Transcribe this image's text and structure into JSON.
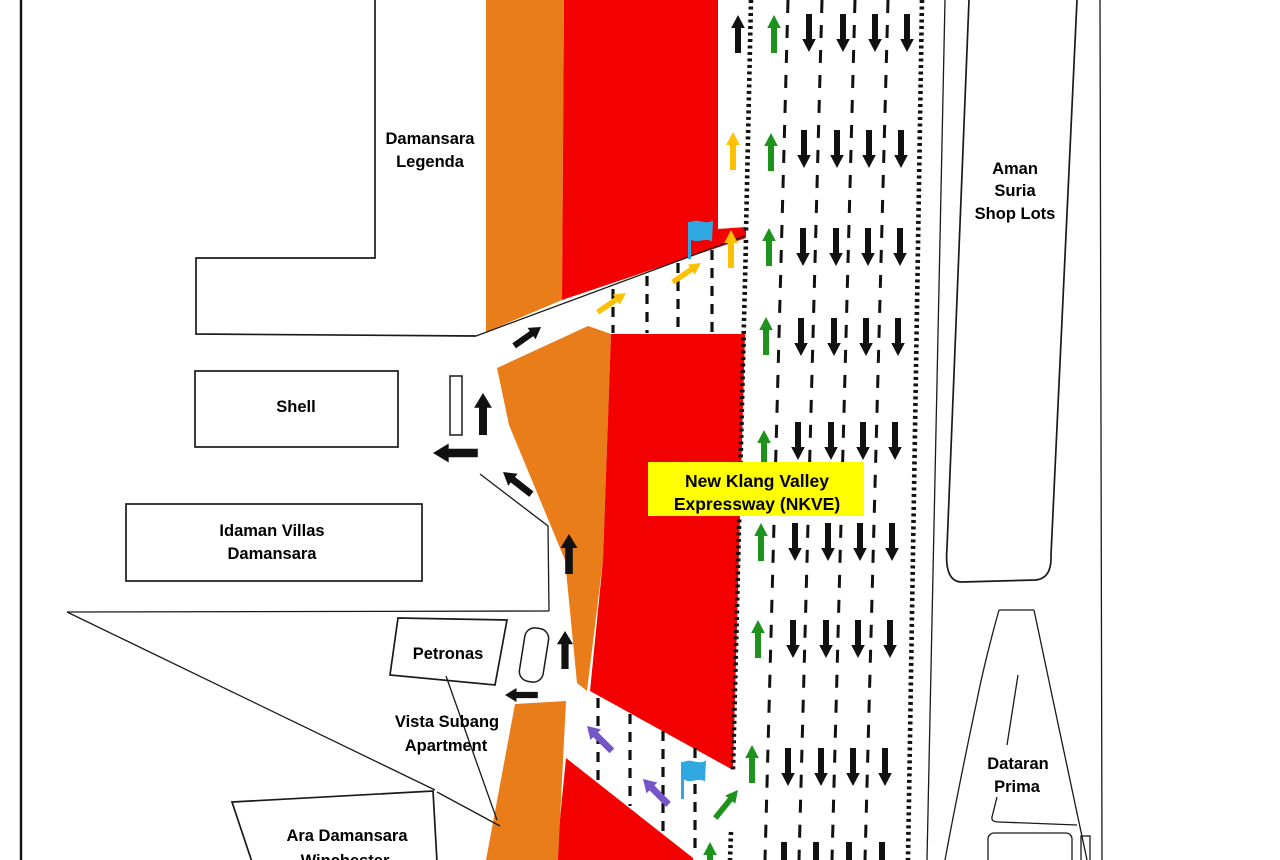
{
  "areas": {
    "damansara_legenda": {
      "line1": "Damansara",
      "line2": "Legenda"
    },
    "shell": {
      "line1": "Shell"
    },
    "idaman_villas": {
      "line1": "Idaman Villas",
      "line2": "Damansara"
    },
    "petronas": {
      "line1": "Petronas"
    },
    "vista_subang": {
      "line1": "Vista Subang",
      "line2": "Apartment"
    },
    "ara_damansara": {
      "line1": "Ara Damansara",
      "line2": "Winchester"
    },
    "aman_suria": {
      "line1": "Aman",
      "line2": "Suria",
      "line3": "Shop Lots"
    },
    "dataran_prima": {
      "line1": "Dataran",
      "line2": "Prima"
    }
  },
  "highway_label": {
    "line1": "New Klang Valley",
    "line2": "Expressway (NKVE)",
    "bg": "#FFFF00"
  },
  "colors": {
    "work_zone_orange": "#E87D1A",
    "closure_red": "#F30000",
    "merge_arrow_yellow": "#FFC000",
    "contraflow_arrow_green": "#1D921D",
    "exit_arrow_purple": "#7456C8",
    "traffic_arrow_black": "#111111",
    "flag_blue": "#2FA8E1"
  }
}
